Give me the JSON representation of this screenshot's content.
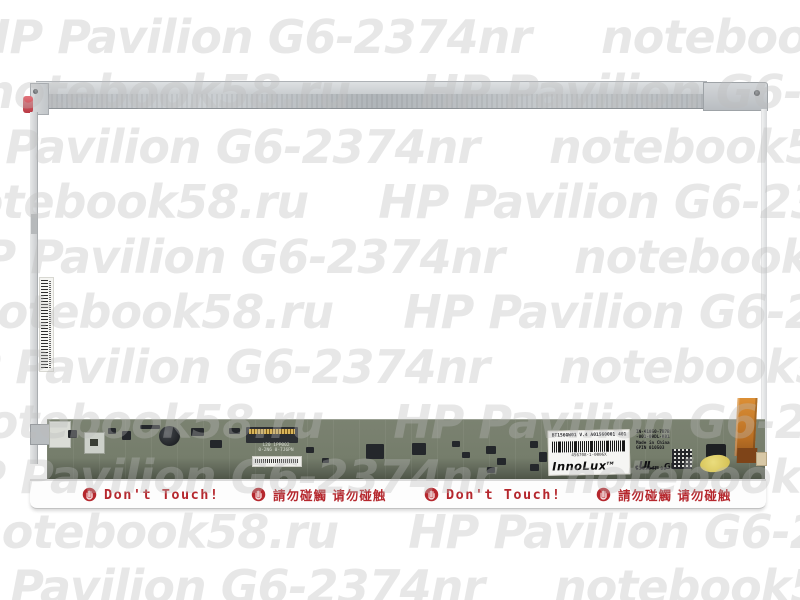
{
  "product": {
    "model_watermark": "HP Pavilion G6-2374nr",
    "site_watermark": "notebook58.ru"
  },
  "watermark": {
    "phrase_a": "HP Pavilion G6-2374nr",
    "phrase_b": "notebook58.ru",
    "color": "#bcbcbc",
    "rows": [
      {
        "first": "a",
        "left": -28
      },
      {
        "first": "b",
        "left": -18
      },
      {
        "first": "a",
        "left": -80
      },
      {
        "first": "b",
        "left": -60
      },
      {
        "first": "a",
        "left": -55
      },
      {
        "first": "b",
        "left": -35
      },
      {
        "first": "a",
        "left": -70
      },
      {
        "first": "b",
        "left": -45
      },
      {
        "first": "a",
        "left": -65
      },
      {
        "first": "b",
        "left": -30
      },
      {
        "first": "a",
        "left": -75
      }
    ]
  },
  "warnings": {
    "icon": "no-touch-hand-icon",
    "groups": [
      {
        "type": "en",
        "text": "Don't  Touch!"
      },
      {
        "type": "cn",
        "text": "請勿碰觸  请勿碰触"
      },
      {
        "type": "en",
        "text": "Don't  Touch!"
      },
      {
        "type": "cn",
        "text": "請勿碰觸  请勿碰触"
      }
    ]
  },
  "board": {
    "connector_text_line1": "L20 1PP002",
    "connector_text_line2": "0-2N6 0-7J6PN",
    "spec_sticker": {
      "line1": "BT156GW01  V.4  A01560001  401",
      "barcode_sub": "456708-1-0006X",
      "brand": "InnoLux",
      "tm": "TM"
    },
    "info_block": {
      "line1": "IN-41050-7B7B",
      "line2": "-001-09DL-K01",
      "line3": "Made in China",
      "line4": "GPIN 010503"
    },
    "ul_mark": {
      "c": "c",
      "ul": "UL",
      "us": "us",
      "gp": "GP",
      "number": "E253547 00"
    }
  },
  "colors": {
    "warning_red": "#b5272d",
    "watermark_gray": "#bcbcbc",
    "pcb_green": "#757d6b",
    "flex_copper": "#c17a2e",
    "kapton_yellow": "#e0d06a",
    "hinge_pad_red": "#c64a52",
    "metal_gray": "#c3c7ca"
  }
}
